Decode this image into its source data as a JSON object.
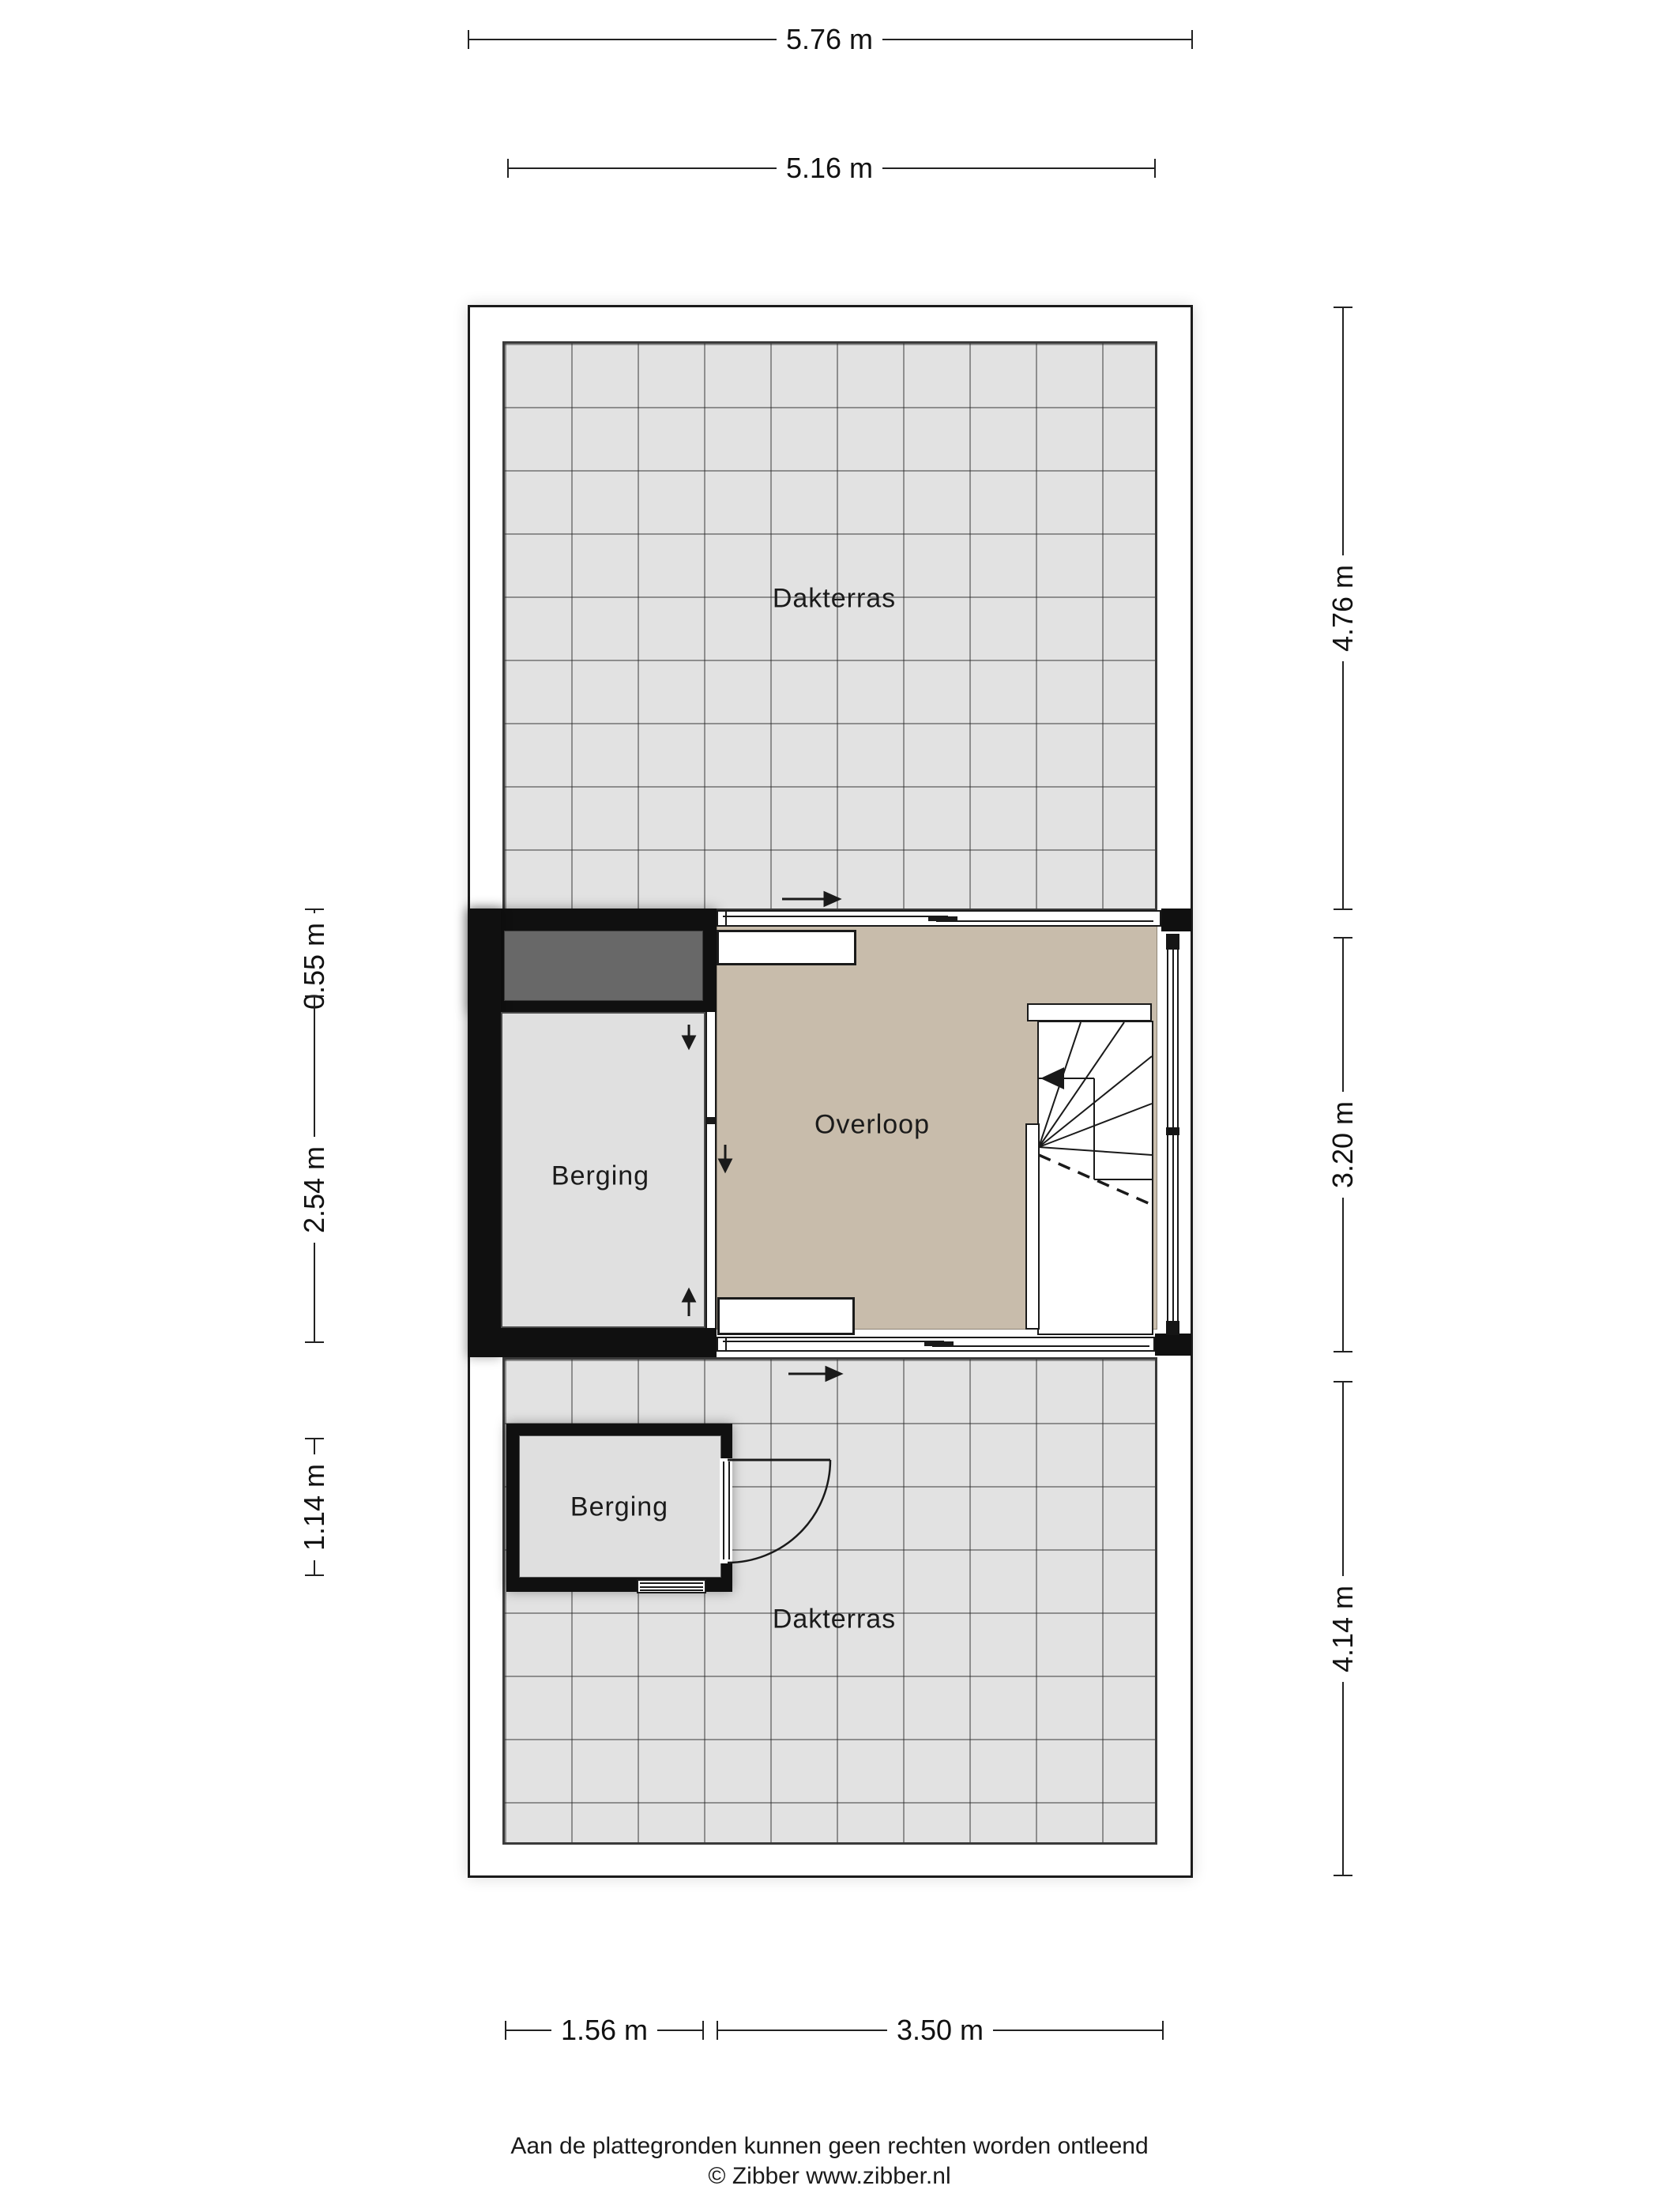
{
  "floorplan": {
    "type": "residential floor plan, attic storey with roof terraces",
    "rooms": {
      "dakterras_top": {
        "label": "Dakterras"
      },
      "berging_mid": {
        "label": "Berging"
      },
      "overloop": {
        "label": "Overloop"
      },
      "berging_bottom": {
        "label": "Berging"
      },
      "dakterras_bottom": {
        "label": "Dakterras"
      }
    },
    "dimensions": {
      "top_outer": "5.76 m",
      "top_inner": "5.16 m",
      "right_top": "4.76 m",
      "right_middle": "3.20 m",
      "right_bottom": "4.14 m",
      "left_upper": "0.55 m",
      "left_middle": "2.54 m",
      "left_lower": "1.14 m",
      "bottom_left": "1.56 m",
      "bottom_right": "3.50 m"
    },
    "footer": {
      "disclaimer": "Aan de plattegronden kunnen geen rechten worden ontleend",
      "credit": "© Zibber www.zibber.nl"
    },
    "colors": {
      "wall": "#101010",
      "tile_floor": "#e2e2e2",
      "tile_line": "#5a5a5a",
      "overloop_floor": "#c8bcab",
      "berging_floor": "#e0e0e0",
      "roof_element": "#686868",
      "background": "#ffffff"
    }
  }
}
